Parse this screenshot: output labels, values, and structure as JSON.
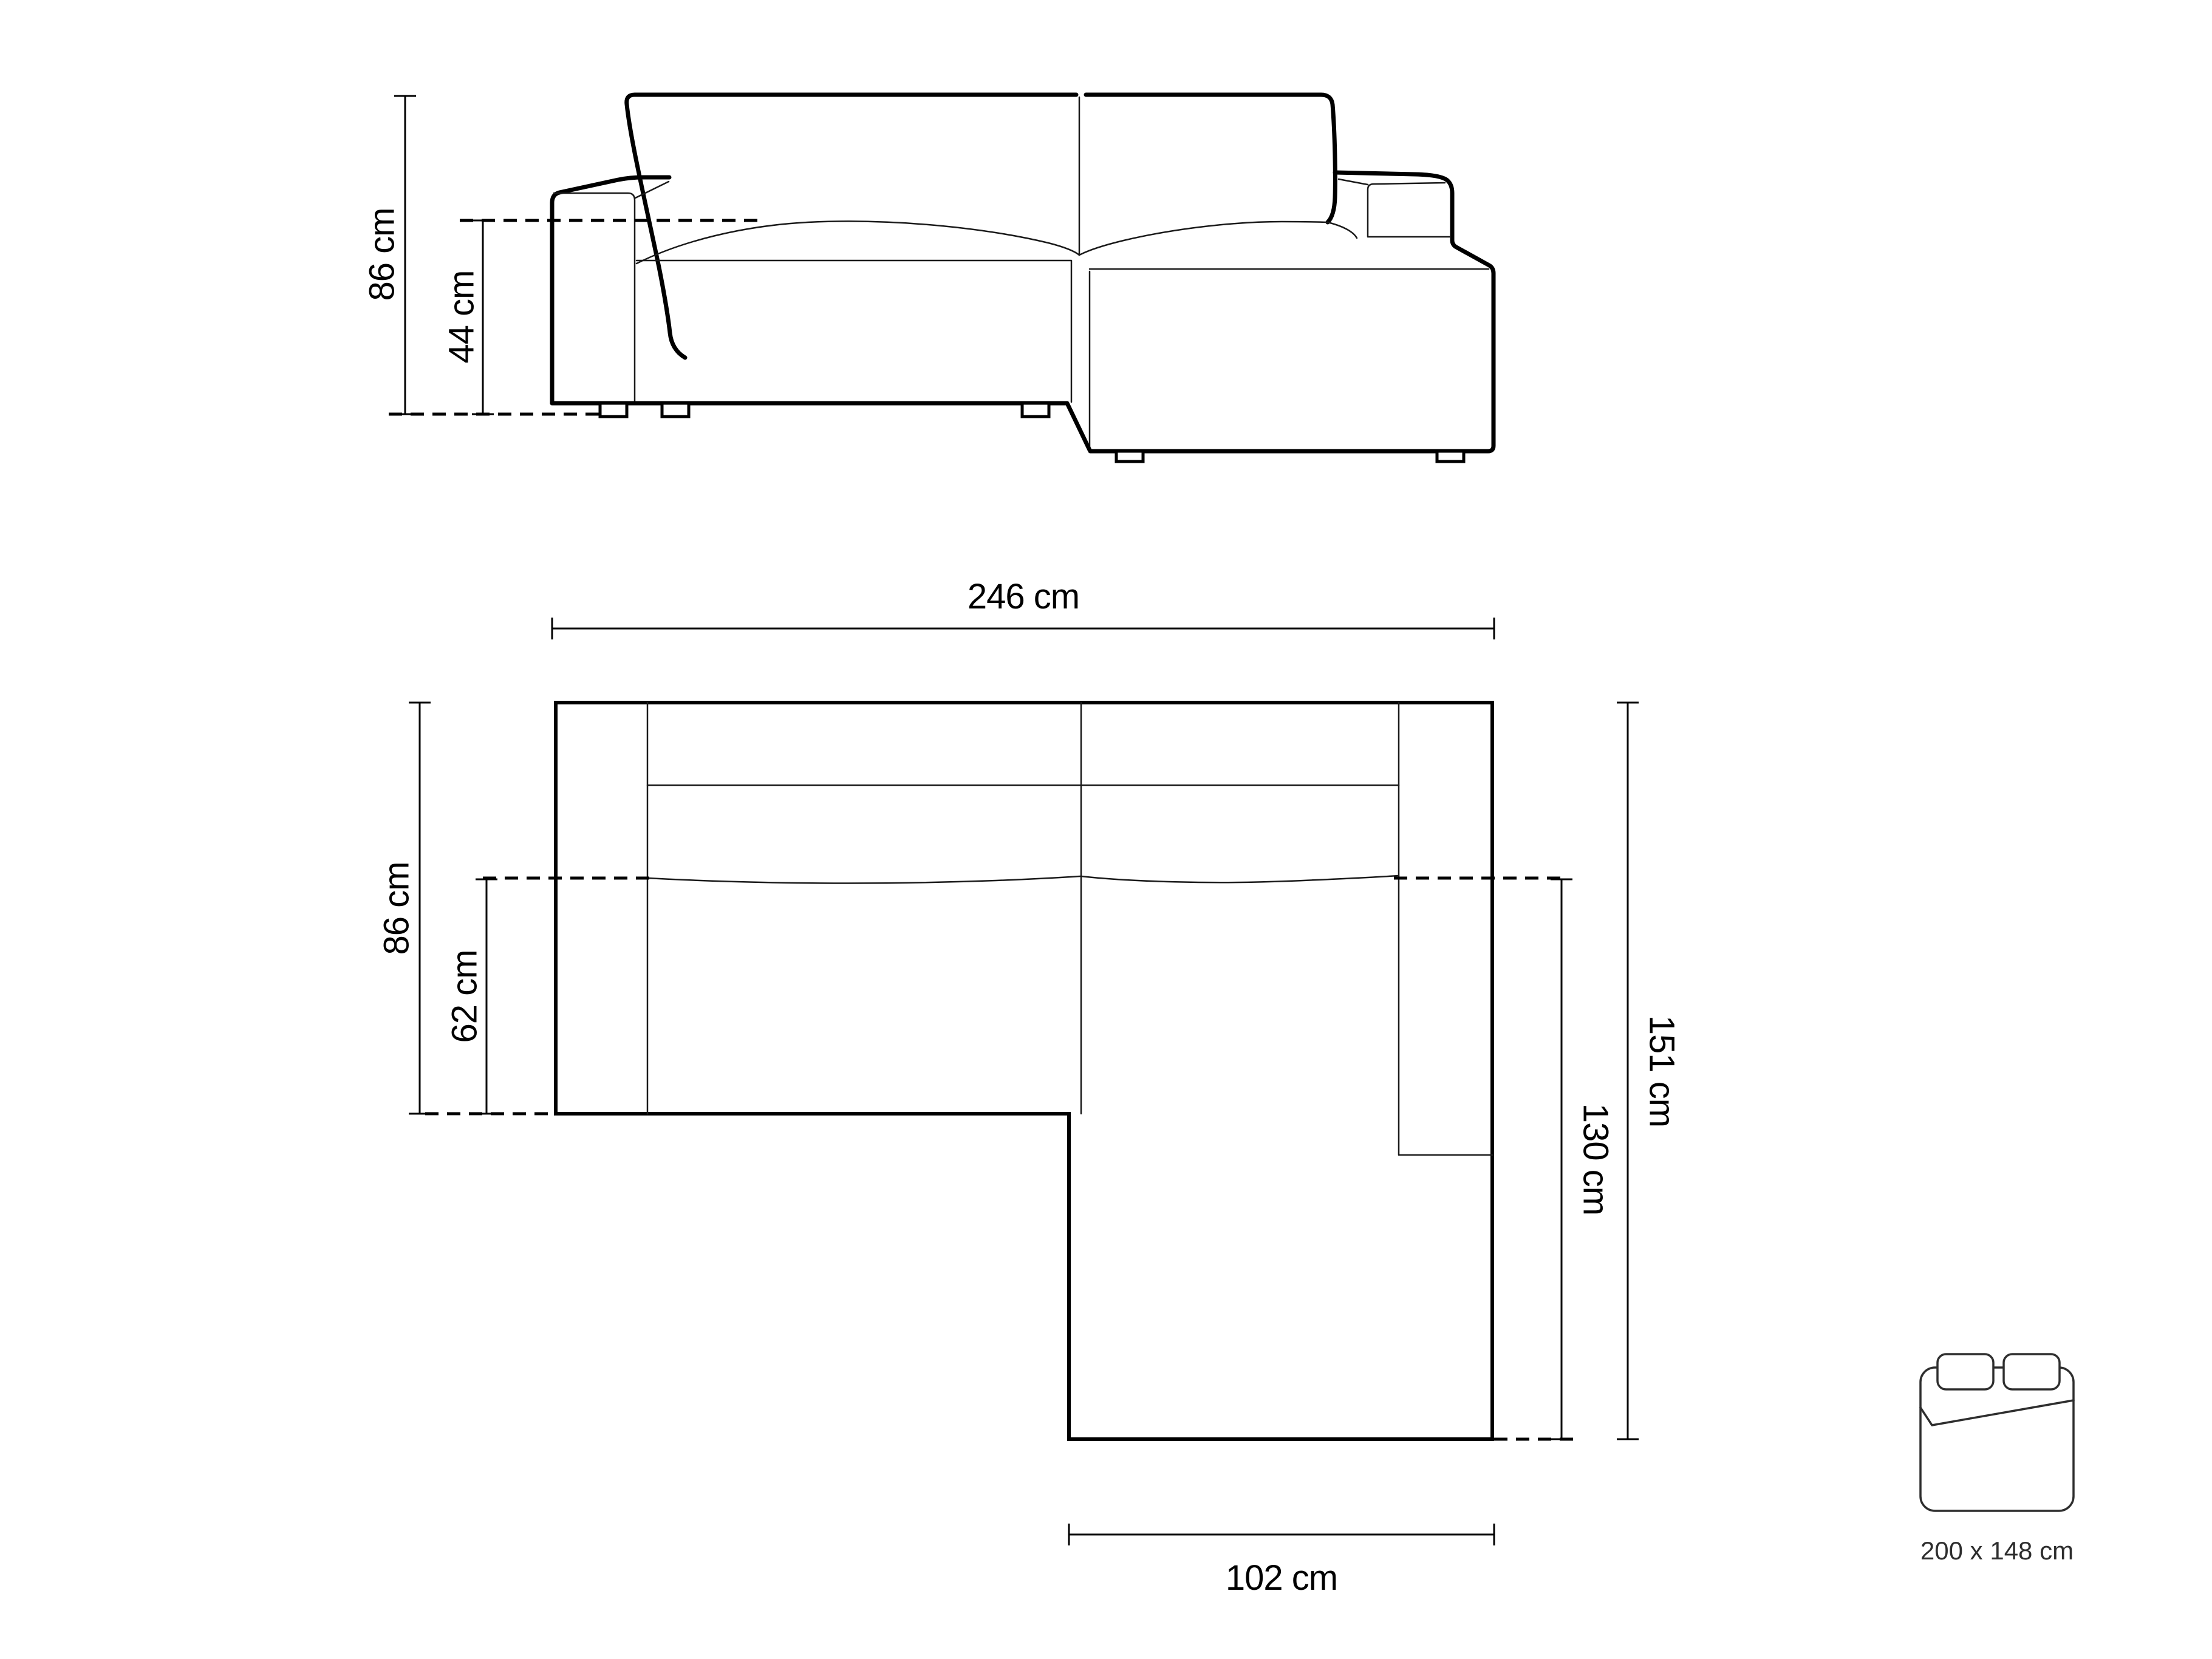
{
  "diagram": {
    "subject": "corner-sofa-with-chaise-dimensions",
    "front_view": {
      "height_label": "86 cm",
      "seat_height_label": "44 cm"
    },
    "plan_view": {
      "width_label": "246 cm",
      "depth_label": "86 cm",
      "seat_depth_label": "62 cm",
      "total_depth_label": "151 cm",
      "chaise_depth_label": "130 cm",
      "chaise_width_label": "102 cm"
    },
    "sleeping_area": {
      "icon": "double-bed-icon",
      "size_label": "200 x 148 cm"
    },
    "colors": {
      "line": "#000000",
      "background": "#ffffff",
      "icon_line": "#2e2e2e"
    }
  }
}
